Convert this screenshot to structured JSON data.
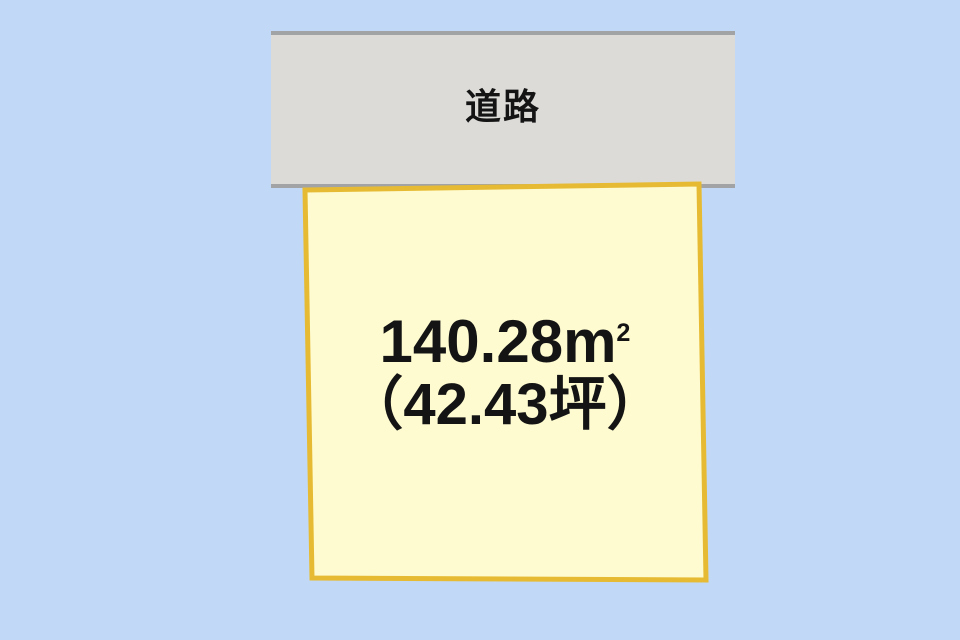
{
  "diagram": {
    "road": {
      "label": "道路"
    },
    "plot": {
      "area_value": "140.28",
      "area_unit": "m",
      "area_unit_sup": "2",
      "area_full": "140.28㎡",
      "tsubo": "（42.43坪）"
    },
    "colors": {
      "background": "#C1D9F6",
      "road_fill": "#DCDBD8",
      "road_border": "#A2A3A5",
      "plot_fill": "#FEFBD0",
      "plot_border": "#E6BB33",
      "text": "#141414"
    },
    "shape": {
      "plot_points": "305,190 699,184 706,580 312,578"
    }
  }
}
